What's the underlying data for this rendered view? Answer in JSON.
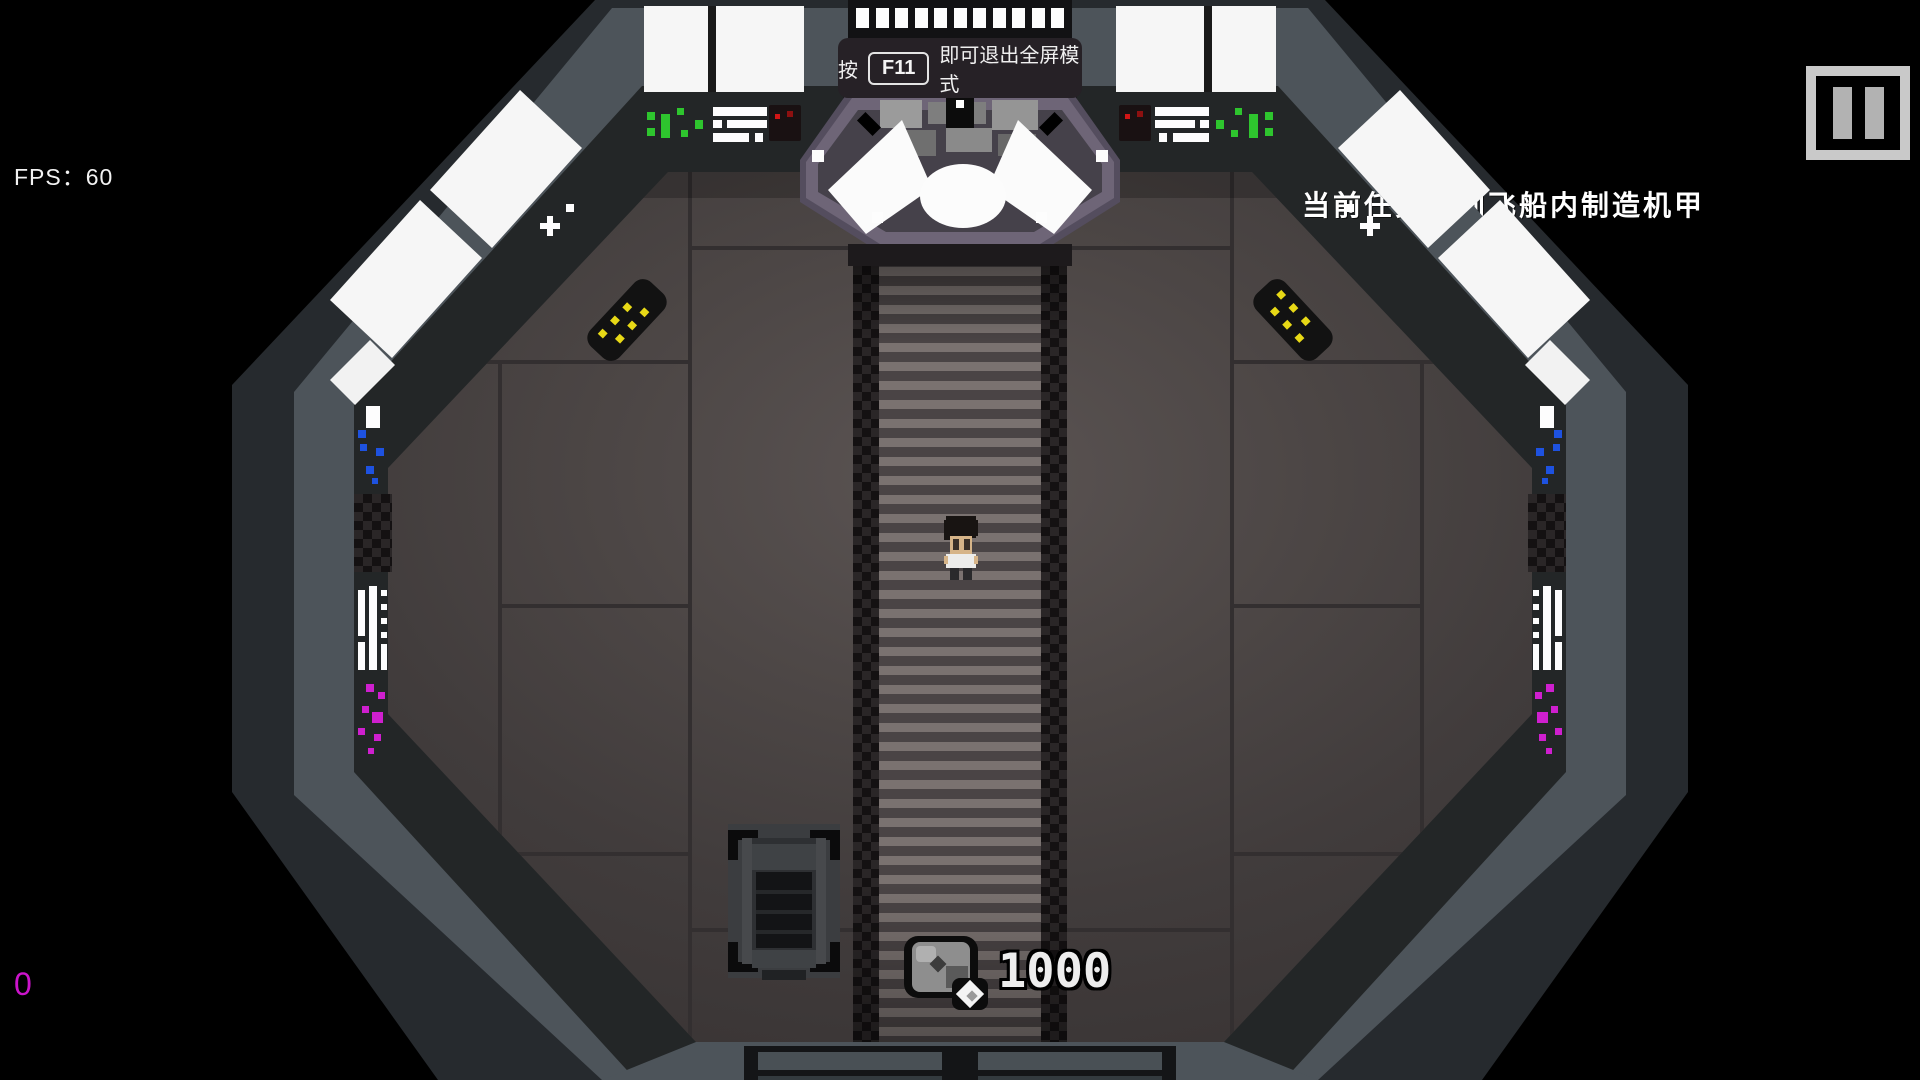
{
  "hud": {
    "fps": {
      "label": "FPS：60"
    },
    "pause_button": {
      "icon": "pause-icon"
    },
    "fullscreen_notice": {
      "prefix": "按",
      "key": "F11",
      "suffix": "即可退出全屏模式"
    },
    "task": {
      "text": "当前任务：到飞船内制造机甲"
    },
    "currency": {
      "icon": "ore-gem-icon",
      "amount": "1000"
    },
    "debug_counter": {
      "value": "0"
    }
  },
  "colors": {
    "background": "#000000",
    "hull_gray": "#4d545a",
    "wall_dark": "#232627",
    "floor_center": "#5b5453",
    "floor_edge": "#3a3535",
    "cockpit_purple": "#6e6577",
    "light_green": "#2ec52e",
    "light_red": "#d01515",
    "light_yellow": "#e8d916",
    "light_blue": "#1e52e0",
    "light_magenta": "#cf1fcf",
    "counter_magenta": "#cb14cb",
    "pause_gray": "#c9c9c9"
  },
  "scene": {
    "player": {
      "sprite": "astronaut-character"
    },
    "objects": [
      {
        "name": "fabricator-bench"
      },
      {
        "name": "cockpit-console"
      },
      {
        "name": "bottom-door"
      }
    ]
  }
}
